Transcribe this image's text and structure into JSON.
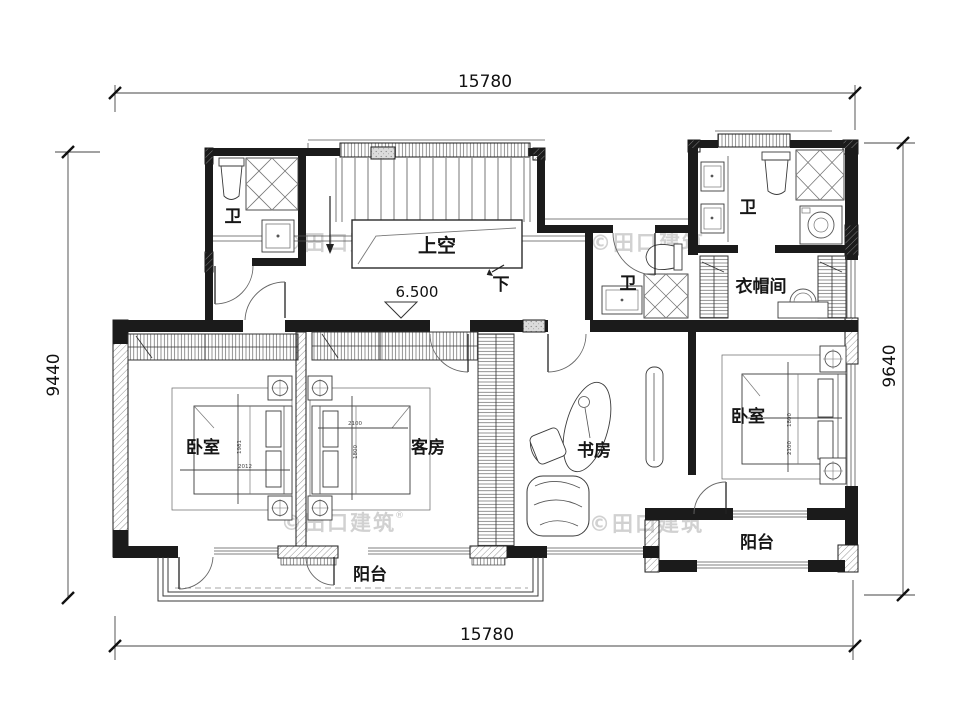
{
  "drawing": {
    "watermark": "©田口建筑",
    "watermark_reg": "®",
    "level": "6.500",
    "dims": {
      "top": "15780",
      "bottom": "15780",
      "left": "9440",
      "right": "9640"
    },
    "labels": {
      "void": "上空",
      "down": "下",
      "bath_tl": "卫",
      "bath_mid": "卫",
      "bath_tr": "卫",
      "closet": "衣帽间",
      "bedroom_left": "卧室",
      "guest": "客房",
      "study": "书房",
      "bedroom_right": "卧室",
      "balcony_left": "阳台",
      "balcony_right": "阳台"
    },
    "bed_dims": {
      "left_vert": "1981",
      "left_horiz": "2012",
      "guest_horiz": "2100",
      "guest_vert": "1800",
      "right_vert_a": "1800",
      "right_vert_b": "2100"
    }
  }
}
